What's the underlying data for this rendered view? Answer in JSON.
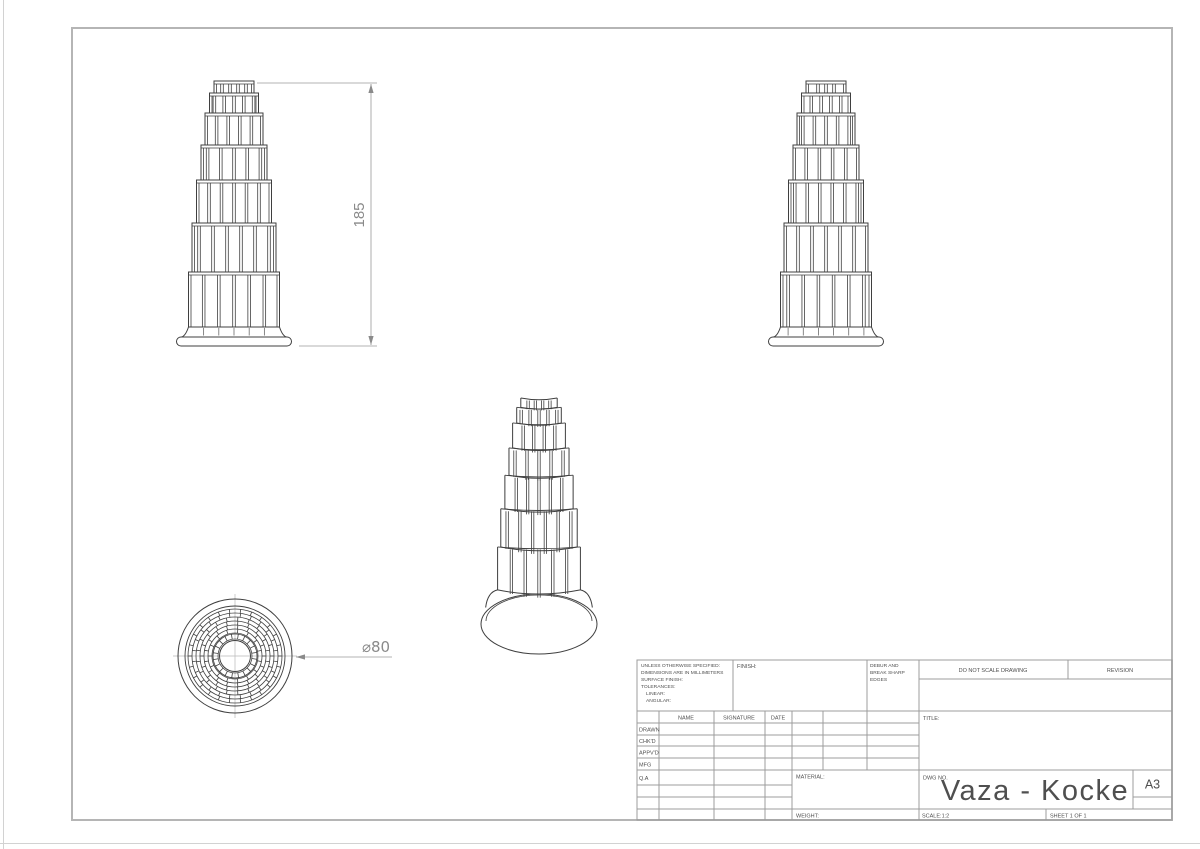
{
  "sheet": {
    "paper_color": "#ffffff",
    "edge_line_color": "#d2d2d2",
    "border_color": "#b5b5b5",
    "drawing_line_color": "#3f3f3f",
    "dim_line_color": "#9a9a9a",
    "dim_text_color": "#8a8a8a",
    "grid_line_color": "#9c9c9c",
    "text_color": "#4f4f4f"
  },
  "dimensions": {
    "height": "185",
    "diameter": "⌀80"
  },
  "title_block": {
    "spec_lines": [
      "UNLESS OTHERWISE SPECIFIED:",
      "DIMENSIONS ARE IN MILLIMETERS",
      "SURFACE FINISH:",
      "TOLERANCES:",
      "LINEAR:",
      "ANGULAR:"
    ],
    "finish_label": "FINISH:",
    "debur_lines": [
      "DEBUR AND",
      "BREAK SHARP",
      "EDGES"
    ],
    "do_not_scale": "DO NOT SCALE DRAWING",
    "revision_label": "REVISION",
    "columns": {
      "name": "NAME",
      "signature": "SIGNATURE",
      "date": "DATE"
    },
    "approval_rows": [
      "DRAWN",
      "CHK'D",
      "APPV'D",
      "MFG",
      "Q.A"
    ],
    "title_label": "TITLE:",
    "material_label": "MATERIAL:",
    "weight_label": "WEIGHT:",
    "dwg_no_label": "DWG NO.",
    "drawing_title": "Vaza - Kocke",
    "paper_size": "A3",
    "scale_text": "SCALE:1:2",
    "sheet_text": "SHEET 1 OF 1"
  },
  "drawing_geometry": {
    "tiers": {
      "heights": [
        12,
        20,
        32,
        35,
        43,
        49,
        55
      ],
      "widths": [
        40,
        49,
        58,
        66,
        75,
        84,
        91
      ],
      "blocks": [
        5,
        5,
        5,
        5,
        6,
        6,
        6
      ]
    },
    "base": {
      "flange_w": 115,
      "flange_h": 9,
      "neck_h": 10
    },
    "front_view": {
      "cx": 234,
      "top": 81,
      "parity": 0
    },
    "side_view": {
      "cx": 826,
      "top": 81,
      "parity": 1
    },
    "iso_view": {
      "cx": 539,
      "top": 398,
      "sx": 0.91,
      "sy": 0.78,
      "base": {
        "cy": 624,
        "rx": 58,
        "ry": 30,
        "rx2": 53,
        "ry2": 26
      }
    },
    "top_view": {
      "cx": 235,
      "cy": 656,
      "outer_r": 57,
      "flange_r": 50,
      "brick_outer_r": 47,
      "band_w": 4,
      "bands": 6,
      "stud_r_outer": 22,
      "stud_r_inner": 17,
      "hole_r": 15.5
    },
    "height_dim": {
      "line_x": 371,
      "y_top": 84,
      "y_bot": 345,
      "ext_top_x1": 257,
      "ext_bot_x1": 299,
      "ext_x2": 377,
      "label_x": 364,
      "label_y": 215
    },
    "dia_dim": {
      "y": 657,
      "x1": 296,
      "x2": 392,
      "label_x": 376,
      "label_y": 652
    }
  }
}
